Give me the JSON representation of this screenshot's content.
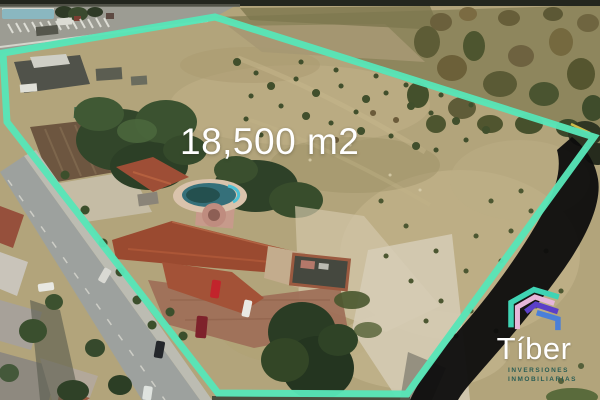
{
  "watermark": {
    "area_label": "18,500 m2"
  },
  "logo": {
    "brand": "Tíber",
    "tagline_line1": "INVERSIONES",
    "tagline_line2": "INMOBILIARIAS"
  },
  "colors": {
    "boundary_teal": "#57e5b7",
    "swoosh_black": "#0d0d0d",
    "area_label_white": "#ffffff",
    "brand_white": "#ffffff",
    "tagline_teal": "#2b5e55",
    "logo_teal": "#3fd4b4",
    "logo_pink": "#e6b6da",
    "logo_purple": "#5b3fc8",
    "logo_blue": "#4a7fd9",
    "accent_yellow": "#ddc94f"
  }
}
